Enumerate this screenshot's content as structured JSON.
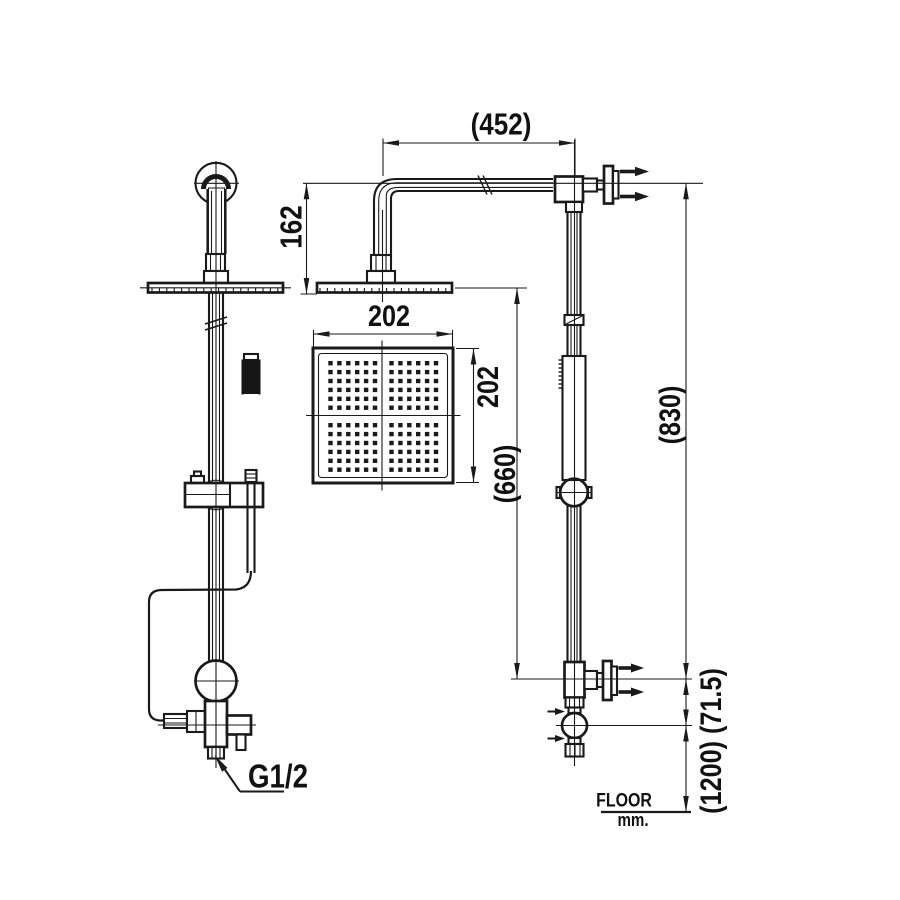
{
  "drawing": {
    "kind": "shower-set dimension drawing",
    "labels": {
      "dim_arm_reach": "(452)",
      "dim_arm_drop": "162",
      "dim_head_width": "202",
      "dim_head_depth": "202",
      "dim_head_to_tee": "(660)",
      "dim_riser": "(830)",
      "dim_lower": "(1200) (71.5)",
      "thread": "G1/2",
      "floor": "FLOOR",
      "floor_unit": "mm."
    },
    "colors": {
      "line": "#1a1a1a",
      "background": "#ffffff"
    }
  }
}
